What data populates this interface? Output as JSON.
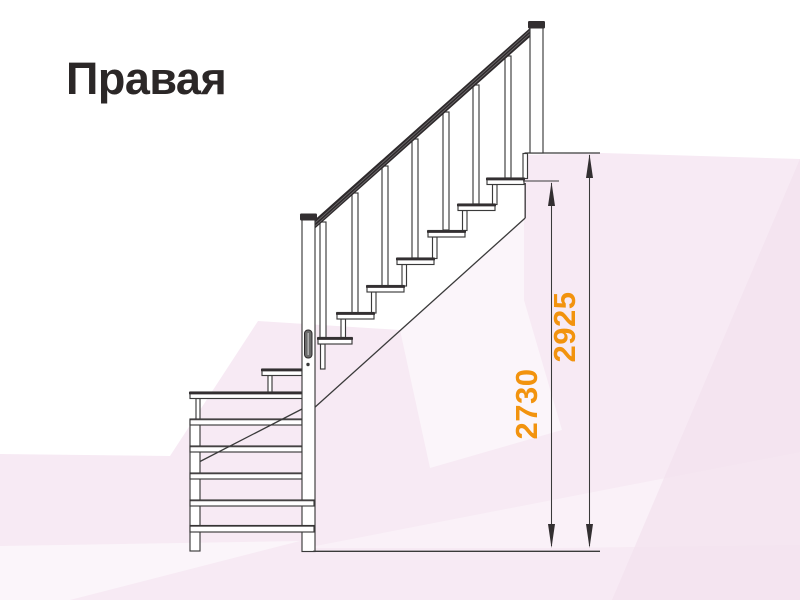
{
  "title": {
    "text": "Правая"
  },
  "dimensions": {
    "inner": {
      "label": "2730"
    },
    "outer": {
      "label": "2925"
    }
  },
  "figure": {
    "kind": "staircase side elevation line drawing",
    "upper_flight_treads": 7,
    "lower_flight_bars": 5,
    "winder_treads": 2,
    "balusters": 7
  },
  "colors": {
    "dimension_text": "#f2930e",
    "drawing_line": "#3a3a3a",
    "background_tint": "#f7eaf4",
    "title_text": "#2b2727"
  }
}
